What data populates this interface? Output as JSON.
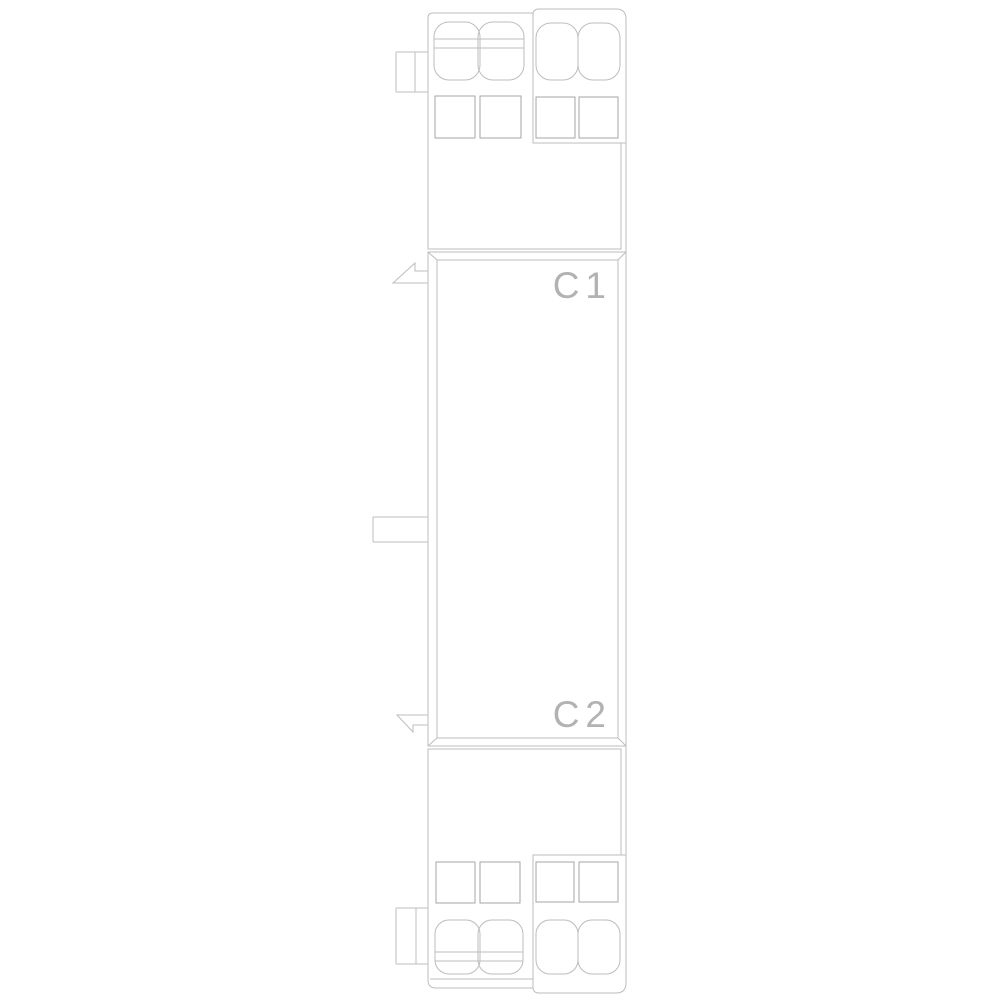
{
  "drawing": {
    "labels": {
      "upper_terminal": "C1",
      "lower_terminal": "C2"
    },
    "colors": {
      "background": "#ffffff",
      "line": "#bdbdbd",
      "line_dark": "#a6a6a6",
      "label": "#b2b2b2"
    }
  }
}
